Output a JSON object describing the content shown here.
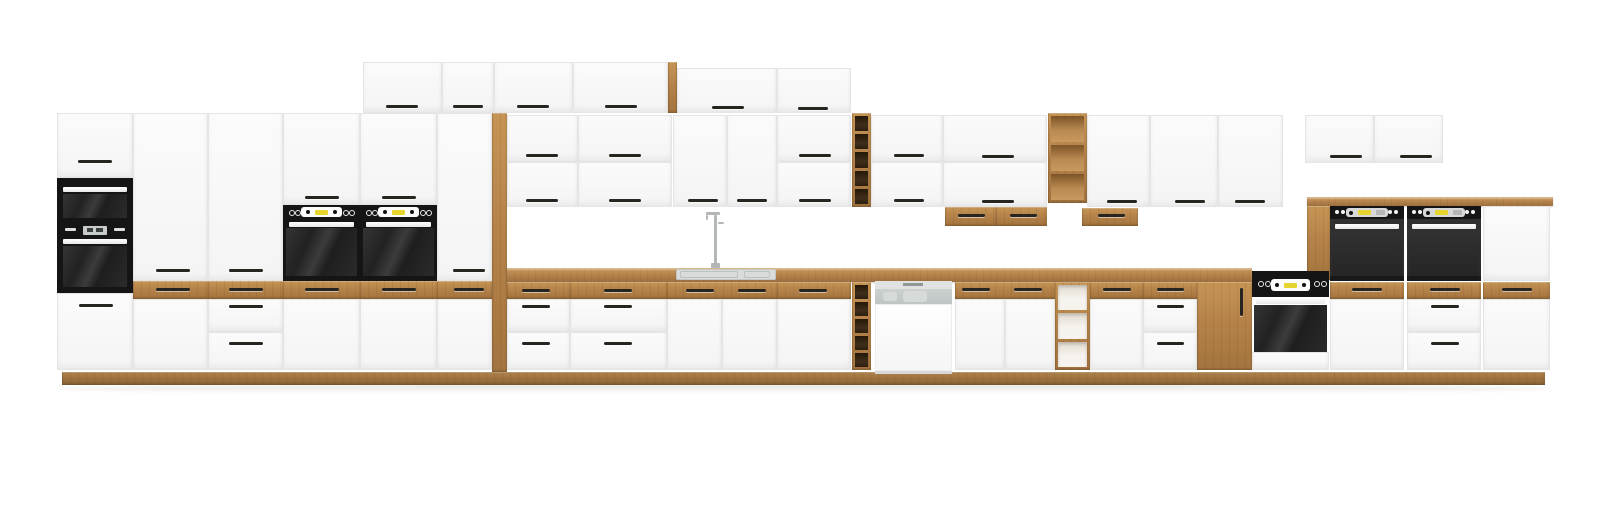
{
  "scene": {
    "description": "Front elevation render of a modular kitchen furniture set: white matte cabinet fronts with oak accents (drawer fronts, open shelves, wine racks, countertop, plinth), black built-in appliances (microwave, ovens), a dishwasher and a sink with tall faucet, on a plain white background.",
    "background": "#ffffff",
    "palette": {
      "oak": "#b5834a",
      "oak_light": "#c99a5d",
      "oak_dark": "#a3743e",
      "cabinet_white": "#f7f7f7",
      "appliance_black": "#151515",
      "appliance_gray": "#2e2e2e",
      "display_yellow": "#e6d52e",
      "steel_gray": "#c6cbca",
      "sink_gray": "#d9dcdb"
    },
    "elements": [
      {
        "n": "floor-shadow",
        "k": "shadow",
        "x": 55,
        "y": 384,
        "w": 1495,
        "h": 10
      },
      {
        "n": "plinth",
        "k": "plinth",
        "x": 62,
        "y": 372,
        "w": 1483,
        "h": 13
      },
      {
        "n": "tall-unit-1-top-door",
        "k": "door",
        "x": 57,
        "y": 113,
        "w": 76,
        "h": 65,
        "hd": [
          95,
          161,
          34
        ]
      },
      {
        "n": "built-in-microwave",
        "k": "microwave",
        "x": 57,
        "y": 178,
        "w": 76,
        "h": 45
      },
      {
        "n": "built-in-oven-left",
        "k": "ovenLeft",
        "x": 57,
        "y": 223,
        "w": 76,
        "h": 70
      },
      {
        "n": "tall-unit-1-bottom-door",
        "k": "door",
        "x": 57,
        "y": 293,
        "w": 76,
        "h": 77,
        "hd": [
          96,
          305,
          34
        ]
      },
      {
        "n": "tall-unit-2-door",
        "k": "door",
        "x": 133,
        "y": 113,
        "w": 75,
        "h": 168,
        "hd": [
          173,
          270,
          34
        ]
      },
      {
        "n": "tall-unit-2-oak-drawer",
        "k": "wood",
        "x": 133,
        "y": 281,
        "w": 75,
        "h": 18,
        "hd": [
          173,
          289,
          34
        ]
      },
      {
        "n": "tall-unit-2-lower-door",
        "k": "door",
        "x": 133,
        "y": 299,
        "w": 75,
        "h": 71
      },
      {
        "n": "tall-unit-3-door",
        "k": "door",
        "x": 208,
        "y": 113,
        "w": 75,
        "h": 168,
        "hd": [
          246,
          270,
          34
        ]
      },
      {
        "n": "tall-unit-3-oak-drawer",
        "k": "wood",
        "x": 208,
        "y": 281,
        "w": 75,
        "h": 18,
        "hd": [
          246,
          289,
          34
        ]
      },
      {
        "n": "tall-unit-3-drawer-1",
        "k": "door",
        "x": 208,
        "y": 299,
        "w": 75,
        "h": 33,
        "hd": [
          246,
          306,
          34
        ]
      },
      {
        "n": "tall-unit-3-drawer-2",
        "k": "door",
        "x": 208,
        "y": 332,
        "w": 75,
        "h": 38,
        "hd": [
          246,
          343,
          34
        ]
      },
      {
        "n": "oven-tower-1-top-door",
        "k": "door",
        "x": 283,
        "y": 113,
        "w": 77,
        "h": 92,
        "hd": [
          322,
          197,
          34
        ]
      },
      {
        "n": "oven-tower-1-oven",
        "k": "ovenTower",
        "x": 283,
        "y": 205,
        "w": 77,
        "h": 76
      },
      {
        "n": "oven-tower-1-oak-drawer",
        "k": "wood",
        "x": 283,
        "y": 281,
        "w": 77,
        "h": 18,
        "hd": [
          322,
          289,
          34
        ]
      },
      {
        "n": "oven-tower-1-lower-door",
        "k": "door",
        "x": 283,
        "y": 299,
        "w": 77,
        "h": 71
      },
      {
        "n": "oven-tower-2-top-door",
        "k": "door",
        "x": 360,
        "y": 113,
        "w": 77,
        "h": 92,
        "hd": [
          399,
          197,
          34
        ]
      },
      {
        "n": "oven-tower-2-oven",
        "k": "ovenTower",
        "x": 360,
        "y": 205,
        "w": 77,
        "h": 76
      },
      {
        "n": "oven-tower-2-oak-drawer",
        "k": "wood",
        "x": 360,
        "y": 281,
        "w": 77,
        "h": 18,
        "hd": [
          399,
          289,
          34
        ]
      },
      {
        "n": "oven-tower-2-lower-door",
        "k": "door",
        "x": 360,
        "y": 299,
        "w": 77,
        "h": 71
      },
      {
        "n": "tall-unit-6-door",
        "k": "door",
        "x": 437,
        "y": 113,
        "w": 55,
        "h": 168,
        "hd": [
          469,
          270,
          32
        ]
      },
      {
        "n": "tall-unit-6-oak-drawer",
        "k": "wood",
        "x": 437,
        "y": 281,
        "w": 55,
        "h": 18,
        "hd": [
          469,
          289,
          30
        ]
      },
      {
        "n": "tall-unit-6-lower-door",
        "k": "door",
        "x": 437,
        "y": 299,
        "w": 55,
        "h": 71
      },
      {
        "n": "oak-side-panel-left",
        "k": "wood",
        "x": 492,
        "y": 113,
        "w": 15,
        "h": 259
      },
      {
        "n": "top-cabinet-1",
        "k": "door",
        "x": 363,
        "y": 62,
        "w": 79,
        "h": 51,
        "hd": [
          402,
          106,
          32
        ]
      },
      {
        "n": "top-cabinet-2",
        "k": "door",
        "x": 442,
        "y": 62,
        "w": 52,
        "h": 51,
        "hd": [
          468,
          106,
          30
        ]
      },
      {
        "n": "top-cabinet-3",
        "k": "door",
        "x": 494,
        "y": 62,
        "w": 79,
        "h": 51,
        "hd": [
          533,
          106,
          32
        ]
      },
      {
        "n": "top-cabinet-4",
        "k": "door",
        "x": 573,
        "y": 62,
        "w": 95,
        "h": 51,
        "hd": [
          621,
          106,
          32
        ]
      },
      {
        "n": "oak-top-edge",
        "k": "wood",
        "x": 668,
        "y": 62,
        "w": 9,
        "h": 51
      },
      {
        "n": "top-cabinet-5",
        "k": "door",
        "x": 677,
        "y": 68,
        "w": 100,
        "h": 45,
        "hd": [
          728,
          107,
          32
        ]
      },
      {
        "n": "top-cabinet-6",
        "k": "door",
        "x": 777,
        "y": 68,
        "w": 74,
        "h": 45,
        "hd": [
          813,
          108,
          30
        ]
      },
      {
        "n": "wall-cab-1-upper",
        "k": "door",
        "x": 507,
        "y": 115,
        "w": 71,
        "h": 47,
        "hd": [
          542,
          155,
          32
        ]
      },
      {
        "n": "wall-cab-1-lower",
        "k": "door",
        "x": 507,
        "y": 162,
        "w": 71,
        "h": 45,
        "hd": [
          542,
          200,
          32
        ]
      },
      {
        "n": "wall-cab-2-upper",
        "k": "door",
        "x": 578,
        "y": 115,
        "w": 94,
        "h": 47,
        "hd": [
          625,
          155,
          32
        ]
      },
      {
        "n": "wall-cab-2-lower",
        "k": "door",
        "x": 578,
        "y": 162,
        "w": 94,
        "h": 45,
        "hd": [
          625,
          200,
          32
        ]
      },
      {
        "n": "wall-cab-sink-left",
        "k": "door",
        "x": 673,
        "y": 115,
        "w": 54,
        "h": 92,
        "hd": [
          703,
          200,
          30
        ]
      },
      {
        "n": "wall-cab-sink-right",
        "k": "door",
        "x": 727,
        "y": 115,
        "w": 50,
        "h": 92,
        "hd": [
          752,
          200,
          30
        ]
      },
      {
        "n": "wall-cab-3-upper",
        "k": "door",
        "x": 777,
        "y": 115,
        "w": 74,
        "h": 47,
        "hd": [
          815,
          155,
          32
        ]
      },
      {
        "n": "wall-cab-3-lower",
        "k": "door",
        "x": 777,
        "y": 162,
        "w": 74,
        "h": 45,
        "hd": [
          815,
          200,
          32
        ]
      },
      {
        "n": "wall-wine-rack",
        "k": "wineDark",
        "x": 852,
        "y": 113,
        "w": 19,
        "h": 94,
        "cells": 5
      },
      {
        "n": "wall-cab-4-upper",
        "k": "door",
        "x": 871,
        "y": 115,
        "w": 72,
        "h": 47,
        "hd": [
          909,
          155,
          30
        ]
      },
      {
        "n": "wall-cab-4-lower",
        "k": "door",
        "x": 871,
        "y": 162,
        "w": 72,
        "h": 45,
        "hd": [
          909,
          200,
          30
        ]
      },
      {
        "n": "wall-cab-5-upper",
        "k": "door",
        "x": 943,
        "y": 115,
        "w": 104,
        "h": 47,
        "hd": [
          998,
          156,
          32
        ]
      },
      {
        "n": "wall-cab-5-lower",
        "k": "door",
        "x": 943,
        "y": 162,
        "w": 104,
        "h": 45,
        "hd": [
          998,
          201,
          32
        ]
      },
      {
        "n": "wall-open-shelf",
        "k": "wineLight",
        "x": 1048,
        "y": 113,
        "w": 39,
        "h": 90,
        "cells": 3
      },
      {
        "n": "wall-cab-6",
        "k": "door",
        "x": 1087,
        "y": 115,
        "w": 63,
        "h": 92,
        "hd": [
          1122,
          201,
          30
        ]
      },
      {
        "n": "wall-cab-7",
        "k": "door",
        "x": 1150,
        "y": 115,
        "w": 68,
        "h": 92,
        "hd": [
          1190,
          201,
          30
        ]
      },
      {
        "n": "wall-cab-8",
        "k": "door",
        "x": 1218,
        "y": 115,
        "w": 65,
        "h": 92,
        "hd": [
          1250,
          201,
          30
        ]
      },
      {
        "n": "under-cabinet-box-1",
        "k": "wood",
        "x": 945,
        "y": 207,
        "w": 51,
        "h": 19,
        "hd": [
          971,
          215,
          27
        ]
      },
      {
        "n": "under-cabinet-box-2",
        "k": "wood",
        "x": 996,
        "y": 207,
        "w": 51,
        "h": 19,
        "hd": [
          1023,
          215,
          27
        ]
      },
      {
        "n": "under-cabinet-box-3",
        "k": "wood",
        "x": 1082,
        "y": 208,
        "w": 56,
        "h": 18,
        "hd": [
          1111,
          215,
          27
        ]
      },
      {
        "n": "wall-right-cab-1",
        "k": "door",
        "x": 1305,
        "y": 115,
        "w": 69,
        "h": 48,
        "hd": [
          1346,
          156,
          32
        ]
      },
      {
        "n": "wall-right-cab-2",
        "k": "door",
        "x": 1374,
        "y": 115,
        "w": 69,
        "h": 48,
        "hd": [
          1416,
          156,
          32
        ]
      },
      {
        "n": "countertop",
        "k": "counter",
        "x": 507,
        "y": 268,
        "w": 745,
        "h": 14
      },
      {
        "n": "sink",
        "k": "sink",
        "x": 676,
        "y": 269,
        "w": 100,
        "h": 11
      },
      {
        "n": "faucet",
        "k": "faucet",
        "x": 706,
        "y": 212,
        "w": 24,
        "h": 56
      },
      {
        "n": "base-drawers-1-oak",
        "k": "wood",
        "x": 507,
        "y": 282,
        "w": 63,
        "h": 17,
        "hd": [
          536,
          290,
          28
        ]
      },
      {
        "n": "base-drawers-1-d1",
        "k": "door",
        "x": 507,
        "y": 299,
        "w": 63,
        "h": 33,
        "hd": [
          536,
          306,
          28
        ]
      },
      {
        "n": "base-drawers-1-d2",
        "k": "door",
        "x": 507,
        "y": 332,
        "w": 63,
        "h": 38,
        "hd": [
          536,
          343,
          28
        ]
      },
      {
        "n": "base-drawers-2-oak",
        "k": "wood",
        "x": 570,
        "y": 282,
        "w": 97,
        "h": 17,
        "hd": [
          618,
          290,
          28
        ]
      },
      {
        "n": "base-drawers-2-d1",
        "k": "door",
        "x": 570,
        "y": 299,
        "w": 97,
        "h": 33,
        "hd": [
          618,
          306,
          28
        ]
      },
      {
        "n": "base-drawers-2-d2",
        "k": "door",
        "x": 570,
        "y": 332,
        "w": 97,
        "h": 38,
        "hd": [
          618,
          343,
          28
        ]
      },
      {
        "n": "sink-base-oak-drawer",
        "k": "wood",
        "x": 667,
        "y": 282,
        "w": 110,
        "h": 17,
        "hds": [
          [
            700,
            290,
            28
          ],
          [
            752,
            290,
            28
          ]
        ]
      },
      {
        "n": "sink-base-door-left",
        "k": "door",
        "x": 667,
        "y": 299,
        "w": 55,
        "h": 71
      },
      {
        "n": "sink-base-door-right",
        "k": "door",
        "x": 722,
        "y": 299,
        "w": 55,
        "h": 71
      },
      {
        "n": "base-cab-3-oak-drawer",
        "k": "wood",
        "x": 777,
        "y": 282,
        "w": 74,
        "h": 17,
        "hd": [
          813,
          290,
          28
        ]
      },
      {
        "n": "base-cab-3-door",
        "k": "door",
        "x": 777,
        "y": 299,
        "w": 74,
        "h": 71
      },
      {
        "n": "base-wine-rack",
        "k": "wineDark",
        "x": 852,
        "y": 282,
        "w": 19,
        "h": 88,
        "cells": 5
      },
      {
        "n": "dishwasher",
        "k": "dishwasher",
        "x": 875,
        "y": 281,
        "w": 77,
        "h": 93
      },
      {
        "n": "base-cab-4-oak-drawer",
        "k": "wood",
        "x": 955,
        "y": 282,
        "w": 100,
        "h": 17,
        "hds": [
          [
            976,
            289,
            28
          ],
          [
            1028,
            289,
            28
          ]
        ]
      },
      {
        "n": "base-cab-4-door-left",
        "k": "door",
        "x": 955,
        "y": 299,
        "w": 50,
        "h": 71
      },
      {
        "n": "base-cab-4-door-right",
        "k": "door",
        "x": 1005,
        "y": 299,
        "w": 50,
        "h": 71
      },
      {
        "n": "base-open-shelf",
        "k": "shelfOpen",
        "x": 1055,
        "y": 282,
        "w": 35,
        "h": 88,
        "cells": 3
      },
      {
        "n": "base-cab-5-oak-drawer",
        "k": "wood",
        "x": 1090,
        "y": 282,
        "w": 53,
        "h": 17,
        "hd": [
          1117,
          289,
          28
        ]
      },
      {
        "n": "base-cab-5-door",
        "k": "door",
        "x": 1090,
        "y": 299,
        "w": 53,
        "h": 71
      },
      {
        "n": "base-drawers-3-oak",
        "k": "wood",
        "x": 1143,
        "y": 282,
        "w": 54,
        "h": 17,
        "hd": [
          1170,
          289,
          27
        ]
      },
      {
        "n": "base-drawers-3-d1",
        "k": "door",
        "x": 1143,
        "y": 299,
        "w": 54,
        "h": 33,
        "hd": [
          1170,
          306,
          27
        ]
      },
      {
        "n": "base-drawers-3-d2",
        "k": "door",
        "x": 1143,
        "y": 332,
        "w": 54,
        "h": 38,
        "hd": [
          1170,
          343,
          27
        ]
      },
      {
        "n": "oak-pantry-door",
        "k": "wood",
        "x": 1197,
        "y": 282,
        "w": 55,
        "h": 88,
        "hv": [
          1241,
          288,
          28
        ]
      },
      {
        "n": "right-counter-top",
        "k": "counter",
        "x": 1307,
        "y": 197,
        "w": 246,
        "h": 9
      },
      {
        "n": "oak-side-panel-right",
        "k": "wood",
        "x": 1307,
        "y": 206,
        "w": 23,
        "h": 74
      },
      {
        "n": "base-oven",
        "k": "ovenBase",
        "x": 1252,
        "y": 271,
        "w": 77,
        "h": 99
      },
      {
        "n": "wall-oven-1",
        "k": "ovenUpper",
        "x": 1330,
        "y": 206,
        "w": 74,
        "h": 75
      },
      {
        "n": "wall-oven-2",
        "k": "ovenUpper",
        "x": 1407,
        "y": 206,
        "w": 74,
        "h": 75
      },
      {
        "n": "right-tall-door-upper",
        "k": "door",
        "x": 1483,
        "y": 206,
        "w": 67,
        "h": 75
      },
      {
        "n": "right-oak-drawer-1",
        "k": "wood",
        "x": 1330,
        "y": 282,
        "w": 74,
        "h": 17,
        "hd": [
          1367,
          289,
          30
        ]
      },
      {
        "n": "right-oak-drawer-2",
        "k": "wood",
        "x": 1407,
        "y": 282,
        "w": 74,
        "h": 17,
        "hd": [
          1445,
          289,
          30
        ]
      },
      {
        "n": "right-oak-drawer-3",
        "k": "wood",
        "x": 1483,
        "y": 282,
        "w": 67,
        "h": 17,
        "hd": [
          1517,
          289,
          30
        ]
      },
      {
        "n": "right-lower-door-1",
        "k": "door",
        "x": 1330,
        "y": 299,
        "w": 74,
        "h": 71
      },
      {
        "n": "right-drawer-d1",
        "k": "door",
        "x": 1407,
        "y": 299,
        "w": 74,
        "h": 33,
        "hd": [
          1445,
          306,
          28
        ]
      },
      {
        "n": "right-drawer-d2",
        "k": "door",
        "x": 1407,
        "y": 332,
        "w": 74,
        "h": 38,
        "hd": [
          1445,
          343,
          28
        ]
      },
      {
        "n": "right-lower-door-2",
        "k": "door",
        "x": 1483,
        "y": 299,
        "w": 67,
        "h": 71
      }
    ]
  }
}
